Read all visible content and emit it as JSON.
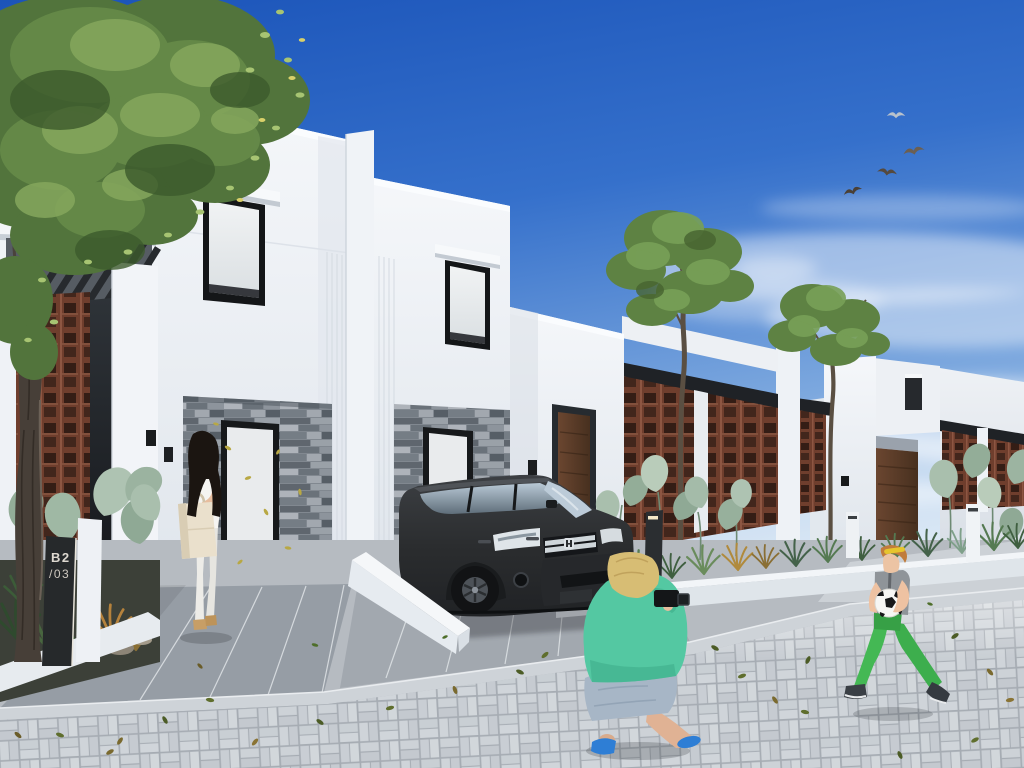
{
  "scene": {
    "type": "architectural exterior rendering",
    "setting": "modern white townhouse street on a sunny day",
    "sign": {
      "line1": "B2",
      "line2": "/03"
    }
  },
  "palette": {
    "sky_top": "#1b54b9",
    "sky_horizon": "#dcebf7",
    "facade_white": "#f5f7fa",
    "stone_cladding": "#818890",
    "brick_lattice": "#6f3e2d",
    "wood_door": "#5c3a24",
    "suv_body": "#2b2d2f",
    "pavers": "#c6cbd1",
    "driveway": "#9aa1a8",
    "tree_foliage": "#5e8243",
    "shopper_bag": "#eae0cc",
    "photographer_sweater": "#54c8a2",
    "photographer_shoes": "#2e7ed5",
    "boy_pants": "#3dae4d",
    "soccer_ball": "#f6f6f4"
  },
  "objects": {
    "buildings": [
      "two-storey duplex townhouses with stone-clad entries",
      "single-storey houses with terracotta brick lattice screens"
    ],
    "vehicle": "dark grey SUV parked in driveway",
    "people": [
      "woman looking into shopping bag",
      "crouching photographer with camera",
      "boy running with soccer ball"
    ],
    "nature": [
      "street trees",
      "desert planting strips",
      "flying birds",
      "scattered leaves"
    ]
  }
}
